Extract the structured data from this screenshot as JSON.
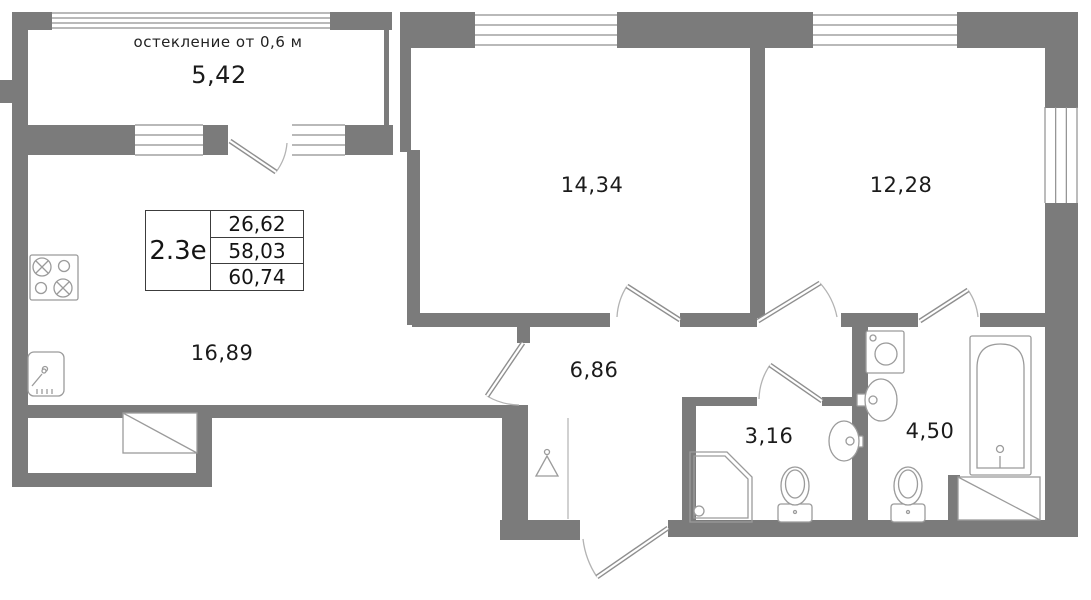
{
  "title": "Floor plan 2.3e apartment",
  "colors": {
    "wall": "#7b7b7b",
    "window_line": "#8f8f8f",
    "door_leaf": "#8f8f8f",
    "door_arc": "#b3b3b3",
    "fixture_line": "#9b9b9b",
    "text": "#1b1b1b"
  },
  "annotation": {
    "glazing_note": "остекление от 0,6 м"
  },
  "info_table": {
    "unit": "2.3е",
    "values": [
      "26,62",
      "58,03",
      "60,74"
    ]
  },
  "labels": {
    "balcony": {
      "text": "5,42"
    },
    "bedroom_1": {
      "text": "14,34"
    },
    "bedroom_2": {
      "text": "12,28"
    },
    "kitchen_living": {
      "text": "16,89"
    },
    "hall": {
      "text": "6,86"
    },
    "bathroom": {
      "text": "3,16"
    },
    "ensuite_bathroom": {
      "text": "4,50"
    }
  },
  "geometry": {
    "walls": [
      [
        12,
        12,
        40,
        18
      ],
      [
        330,
        12,
        62,
        18
      ],
      [
        12,
        12,
        16,
        475
      ],
      [
        28,
        125,
        107,
        30
      ],
      [
        203,
        125,
        25,
        30
      ],
      [
        345,
        125,
        48,
        30
      ],
      [
        384,
        30,
        5,
        97
      ],
      [
        400,
        12,
        75,
        36
      ],
      [
        617,
        12,
        196,
        36
      ],
      [
        957,
        12,
        121,
        36
      ],
      [
        400,
        48,
        11,
        104
      ],
      [
        407,
        150,
        13,
        175
      ],
      [
        1045,
        48,
        33,
        60
      ],
      [
        1045,
        203,
        33,
        334
      ],
      [
        750,
        48,
        15,
        270
      ],
      [
        412,
        313,
        198,
        14
      ],
      [
        680,
        313,
        77,
        14
      ],
      [
        841,
        313,
        77,
        14
      ],
      [
        980,
        313,
        65,
        14
      ],
      [
        517,
        313,
        13,
        30
      ],
      [
        12,
        405,
        498,
        13
      ],
      [
        12,
        473,
        200,
        14
      ],
      [
        196,
        415,
        16,
        60
      ],
      [
        502,
        405,
        26,
        120
      ],
      [
        500,
        520,
        80,
        20
      ],
      [
        668,
        520,
        410,
        17
      ],
      [
        682,
        397,
        14,
        126
      ],
      [
        682,
        397,
        75,
        9
      ],
      [
        822,
        397,
        38,
        9
      ],
      [
        852,
        327,
        16,
        196
      ],
      [
        948,
        475,
        12,
        47
      ],
      [
        0,
        80,
        12,
        23
      ]
    ],
    "windows": [
      {
        "r": [
          52,
          13,
          278,
          15
        ],
        "dir": "h"
      },
      {
        "r": [
          135,
          125,
          68,
          30
        ],
        "dir": "h"
      },
      {
        "r": [
          292,
          125,
          53,
          30
        ],
        "dir": "h"
      },
      {
        "r": [
          475,
          15,
          142,
          30
        ],
        "dir": "h"
      },
      {
        "r": [
          813,
          15,
          144,
          30
        ],
        "dir": "h"
      },
      {
        "r": [
          1045,
          107,
          32,
          96
        ],
        "dir": "v"
      }
    ],
    "doors": [
      {
        "name": "balcony-door",
        "leaf": [
          230,
          141,
          276,
          172
        ],
        "arc": "M276,172 A55,55 0 0 0 287,143"
      },
      {
        "name": "kitchen-door",
        "leaf": [
          523,
          343,
          487,
          396
        ],
        "arc": "M487,396 A64,64 0 0 0 519,405"
      },
      {
        "name": "bedroom1-door",
        "leaf": [
          680,
          320,
          627,
          286
        ],
        "arc": "M627,286 A63,63 0 0 0 617,317"
      },
      {
        "name": "bedroom2-door",
        "leaf": [
          758,
          321,
          820,
          283
        ],
        "arc": "M820,283 A72,72 0 0 1 837,317"
      },
      {
        "name": "ensuite-door",
        "leaf": [
          920,
          321,
          968,
          290
        ],
        "arc": "M968,290 A57,57 0 0 1 978,317"
      },
      {
        "name": "bathroom-door",
        "leaf": [
          822,
          401,
          770,
          365
        ],
        "arc": "M770,365 A63,63 0 0 0 759,399"
      },
      {
        "name": "entrance-door",
        "leaf": [
          668,
          528,
          597,
          577
        ],
        "arc": "M597,577 A86,86 0 0 1 583,539"
      }
    ],
    "fixtures": [
      {
        "name": "stove-icon",
        "items": [
          {
            "t": "rect",
            "a": [
              30,
              255,
              48,
              45,
              2
            ]
          },
          {
            "t": "c",
            "a": [
              42,
              267,
              9
            ]
          },
          {
            "t": "p",
            "d": "M36,261 l12,12 M48,261 l-12,12"
          },
          {
            "t": "c",
            "a": [
              64,
              266,
              5.5
            ]
          },
          {
            "t": "c",
            "a": [
              41,
              288,
              5.5
            ]
          },
          {
            "t": "c",
            "a": [
              63,
              288,
              9
            ]
          },
          {
            "t": "p",
            "d": "M57,282 l12,12 M69,282 l-12,12"
          }
        ]
      },
      {
        "name": "kitchen-sink-icon",
        "items": [
          {
            "t": "rect",
            "a": [
              28,
              352,
              36,
              44,
              6
            ]
          },
          {
            "t": "c",
            "a": [
              45,
              369,
              2.5
            ]
          },
          {
            "t": "l",
            "a": [
              32,
              386,
              42,
              374
            ]
          },
          {
            "t": "c",
            "a": [
              44,
              371,
              2
            ]
          },
          {
            "t": "p",
            "d": "M37,389 v5 M42,389 v5 M47,389 v5 M52,389 v5"
          }
        ]
      },
      {
        "name": "bay-slab-icon",
        "items": [
          {
            "t": "rect",
            "a": [
              123,
              413,
              74,
              40,
              0
            ]
          },
          {
            "t": "l",
            "a": [
              123,
              413,
              197,
              453
            ]
          }
        ]
      },
      {
        "name": "wardrobe-front-line",
        "items": [
          {
            "t": "l",
            "a": [
              568,
              418,
              568,
              519
            ],
            "s": "#b8b8b8"
          }
        ]
      },
      {
        "name": "hanger-icon",
        "items": [
          {
            "t": "c",
            "a": [
              547,
              452,
              2.5
            ]
          },
          {
            "t": "p",
            "d": "M536,476 L547,456 L558,476 Z"
          }
        ]
      },
      {
        "name": "shower-icon",
        "items": [
          {
            "t": "p",
            "d": "M690,452 L727,452 L752,477 L752,522 L690,522 Z"
          },
          {
            "t": "p",
            "d": "M694,456 L725,456 L748,479 L748,518 L694,518 Z"
          },
          {
            "t": "c",
            "a": [
              699,
              511,
              5
            ]
          }
        ]
      },
      {
        "name": "toilet-icon",
        "items": [
          {
            "t": "rect",
            "a": [
              778,
              504,
              34,
              18,
              3
            ]
          },
          {
            "t": "e",
            "a": [
              795,
              486,
              14,
              19
            ]
          },
          {
            "t": "e",
            "a": [
              795,
              484,
              9.5,
              14
            ]
          },
          {
            "t": "c",
            "a": [
              795,
              512,
              1.5
            ]
          }
        ]
      },
      {
        "name": "toilet-icon",
        "items": [
          {
            "t": "rect",
            "a": [
              891,
              504,
              34,
              18,
              3
            ]
          },
          {
            "t": "e",
            "a": [
              908,
              486,
              14,
              19
            ]
          },
          {
            "t": "e",
            "a": [
              908,
              484,
              9.5,
              14
            ]
          },
          {
            "t": "c",
            "a": [
              908,
              512,
              1.5
            ]
          }
        ]
      },
      {
        "name": "washbasin-icon",
        "items": [
          {
            "t": "rect",
            "a": [
              854,
              436,
              9,
              11,
              1
            ]
          },
          {
            "t": "e",
            "a": [
              844,
              441,
              15,
              20
            ]
          },
          {
            "t": "c",
            "a": [
              850,
              441,
              4
            ]
          }
        ]
      },
      {
        "name": "washbasin-icon",
        "items": [
          {
            "t": "rect",
            "a": [
              857,
              394,
              9,
              12,
              1
            ]
          },
          {
            "t": "e",
            "a": [
              881,
              400,
              16,
              21
            ]
          },
          {
            "t": "c",
            "a": [
              873,
              400,
              4
            ]
          }
        ]
      },
      {
        "name": "washing-machine-icon",
        "items": [
          {
            "t": "rect",
            "a": [
              866,
              331,
              38,
              42,
              2
            ]
          },
          {
            "t": "c",
            "a": [
              886,
              354,
              11
            ]
          },
          {
            "t": "c",
            "a": [
              873,
              338,
              3
            ]
          }
        ]
      },
      {
        "name": "bathtub-icon",
        "items": [
          {
            "t": "rect",
            "a": [
              970,
              336,
              61,
              139,
              2
            ]
          },
          {
            "t": "p",
            "d": "M977,468 V368 Q977,344 1000.5,344 Q1024,344 1024,368 V468 Z"
          },
          {
            "t": "c",
            "a": [
              1000,
              449,
              3.5
            ]
          },
          {
            "t": "l",
            "a": [
              1000,
              456,
              1000,
              468
            ]
          }
        ]
      },
      {
        "name": "duct-shaft-icon",
        "items": [
          {
            "t": "rect",
            "a": [
              958,
              477,
              82,
              43,
              0
            ]
          },
          {
            "t": "l",
            "a": [
              958,
              477,
              1040,
              520
            ]
          }
        ]
      }
    ]
  }
}
